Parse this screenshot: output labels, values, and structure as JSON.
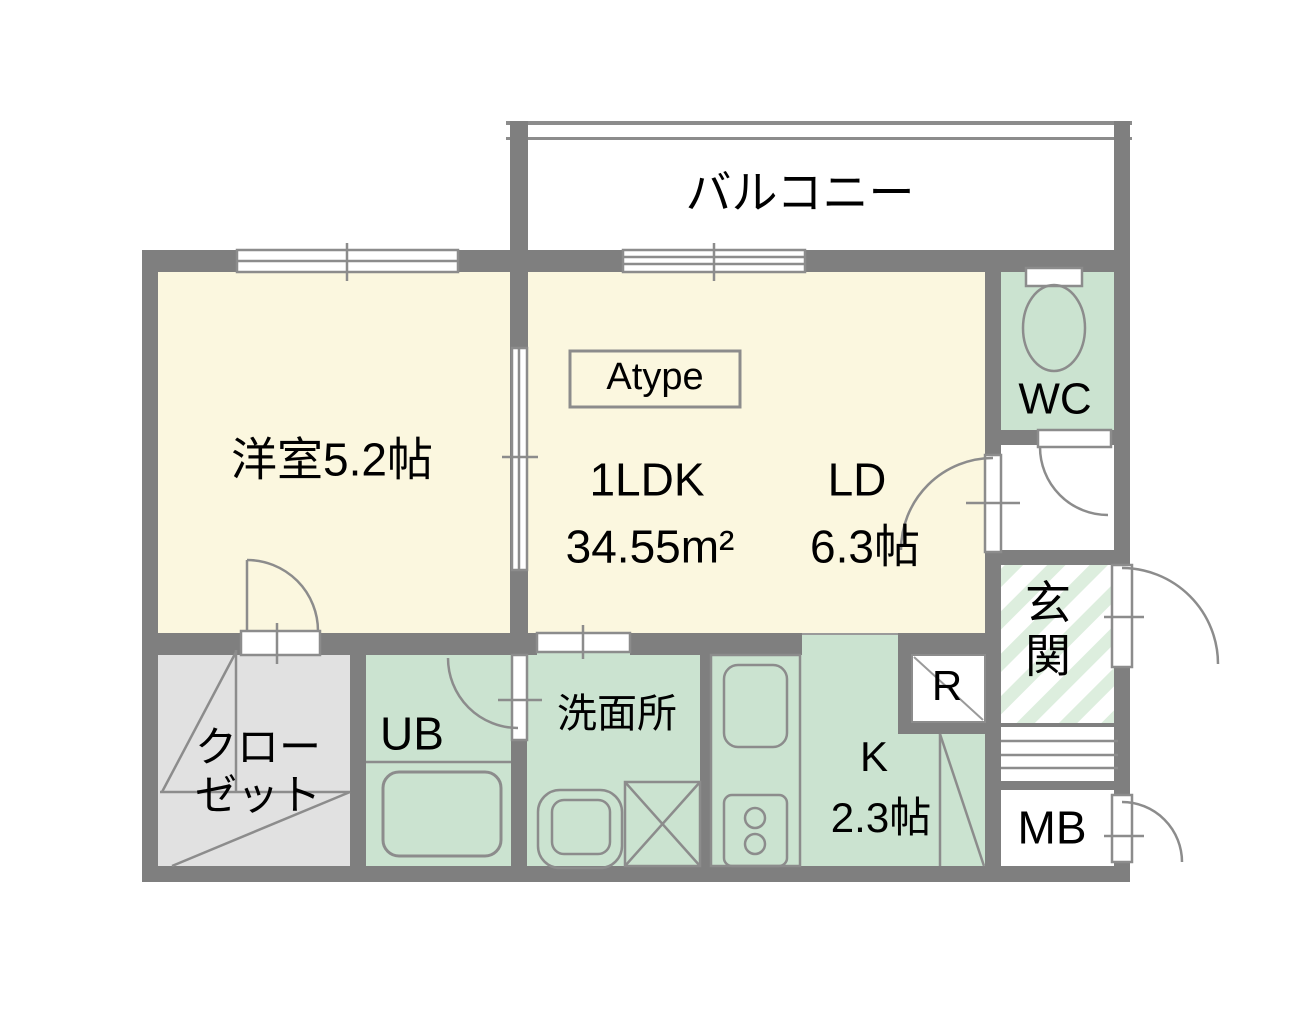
{
  "floorplan": {
    "balcony_label": "バルコニー",
    "western_room_label": "洋室5.2帖",
    "type_badge": "Atype",
    "layout_type": "1LDK",
    "total_area": "34.55m²",
    "living_dining_label": "LD",
    "living_dining_size": "6.3帖",
    "toilet_label": "WC",
    "entrance_label": "玄関",
    "closet_label": "クローゼット",
    "unit_bath_label": "UB",
    "washroom_label": "洗面所",
    "kitchen_label": "K",
    "kitchen_size": "2.3帖",
    "refrigerator_label": "R",
    "meter_box_label": "MB"
  },
  "colors": {
    "wall_gray": "#7f7f7f",
    "fixture_line_gray": "#8c8c8c",
    "room_floor_cream": "#fbf7df",
    "wet_area_green": "#cbe3d0",
    "entrance_stripe_green": "#ddeede",
    "closet_gray": "#e1e1e1",
    "text_black": "#000000"
  },
  "icons": [
    "toilet-icon",
    "bathtub-icon",
    "washbasin-icon",
    "washing-machine-icon",
    "kitchen-sink-icon",
    "stove-icon",
    "door-swing-icon",
    "sliding-window-icon",
    "closet-door-icon",
    "refrigerator-box-icon"
  ]
}
